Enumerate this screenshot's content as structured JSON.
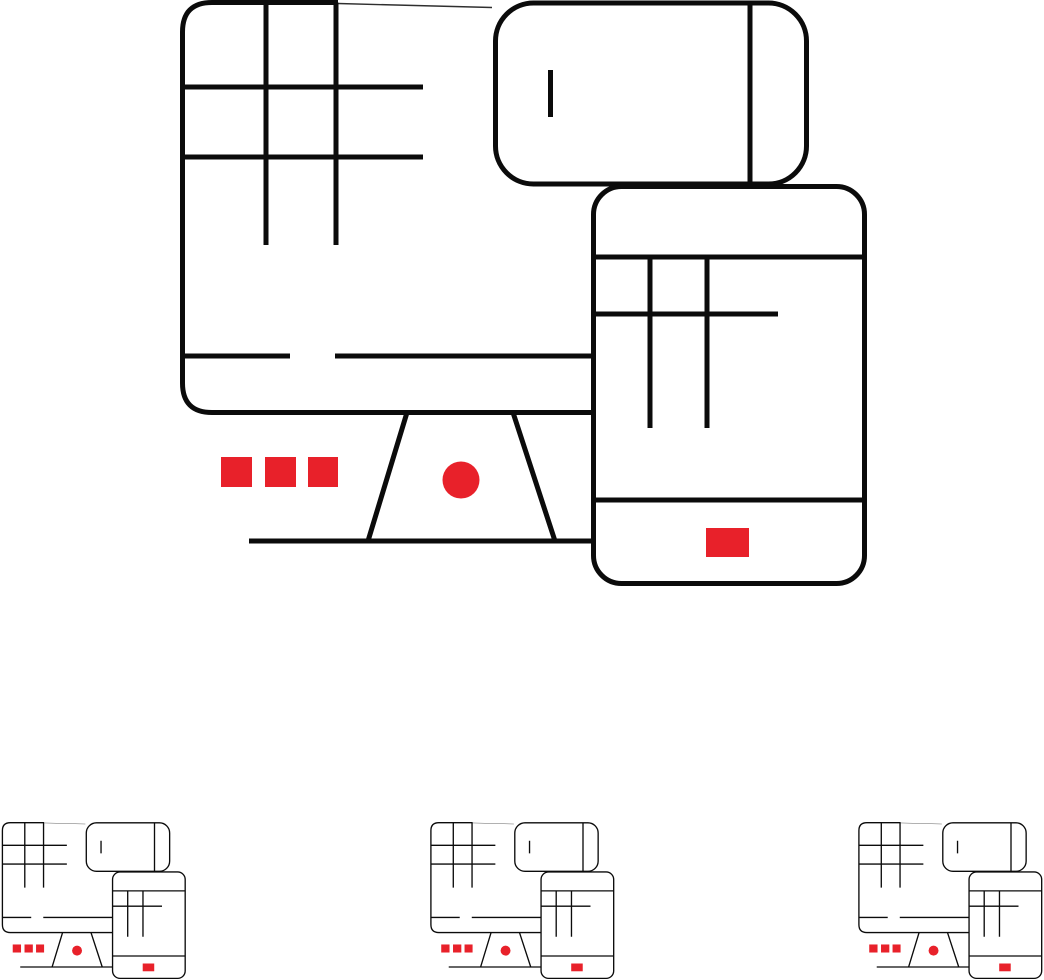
{
  "canvas": {
    "width": 1044,
    "height": 980,
    "background": "#ffffff"
  },
  "palette": {
    "line_color": "#0b0b0b",
    "accent_color": "#e8212a",
    "fill_color": "#ffffff"
  },
  "artwork": {
    "name": "computer-mobile-tablet-thin-line-icon",
    "devices": [
      {
        "id": "monitor",
        "label": "desktop-monitor-with-grid-screen-and-stand"
      },
      {
        "id": "smartphone",
        "label": "smartphone-landscape-with-speaker-and-divider"
      },
      {
        "id": "tablet",
        "label": "tablet-portrait-with-grid-screen-and-home-button"
      }
    ],
    "accents": {
      "monitor_red_squares": 3,
      "monitor_red_dot": 1,
      "tablet_red_home_button": 1
    },
    "thumbnails": [
      {
        "id": "thumbnail-left",
        "scale": 0.268
      },
      {
        "id": "thumbnail-center",
        "scale": 0.268
      },
      {
        "id": "thumbnail-right",
        "scale": 0.268
      }
    ]
  }
}
